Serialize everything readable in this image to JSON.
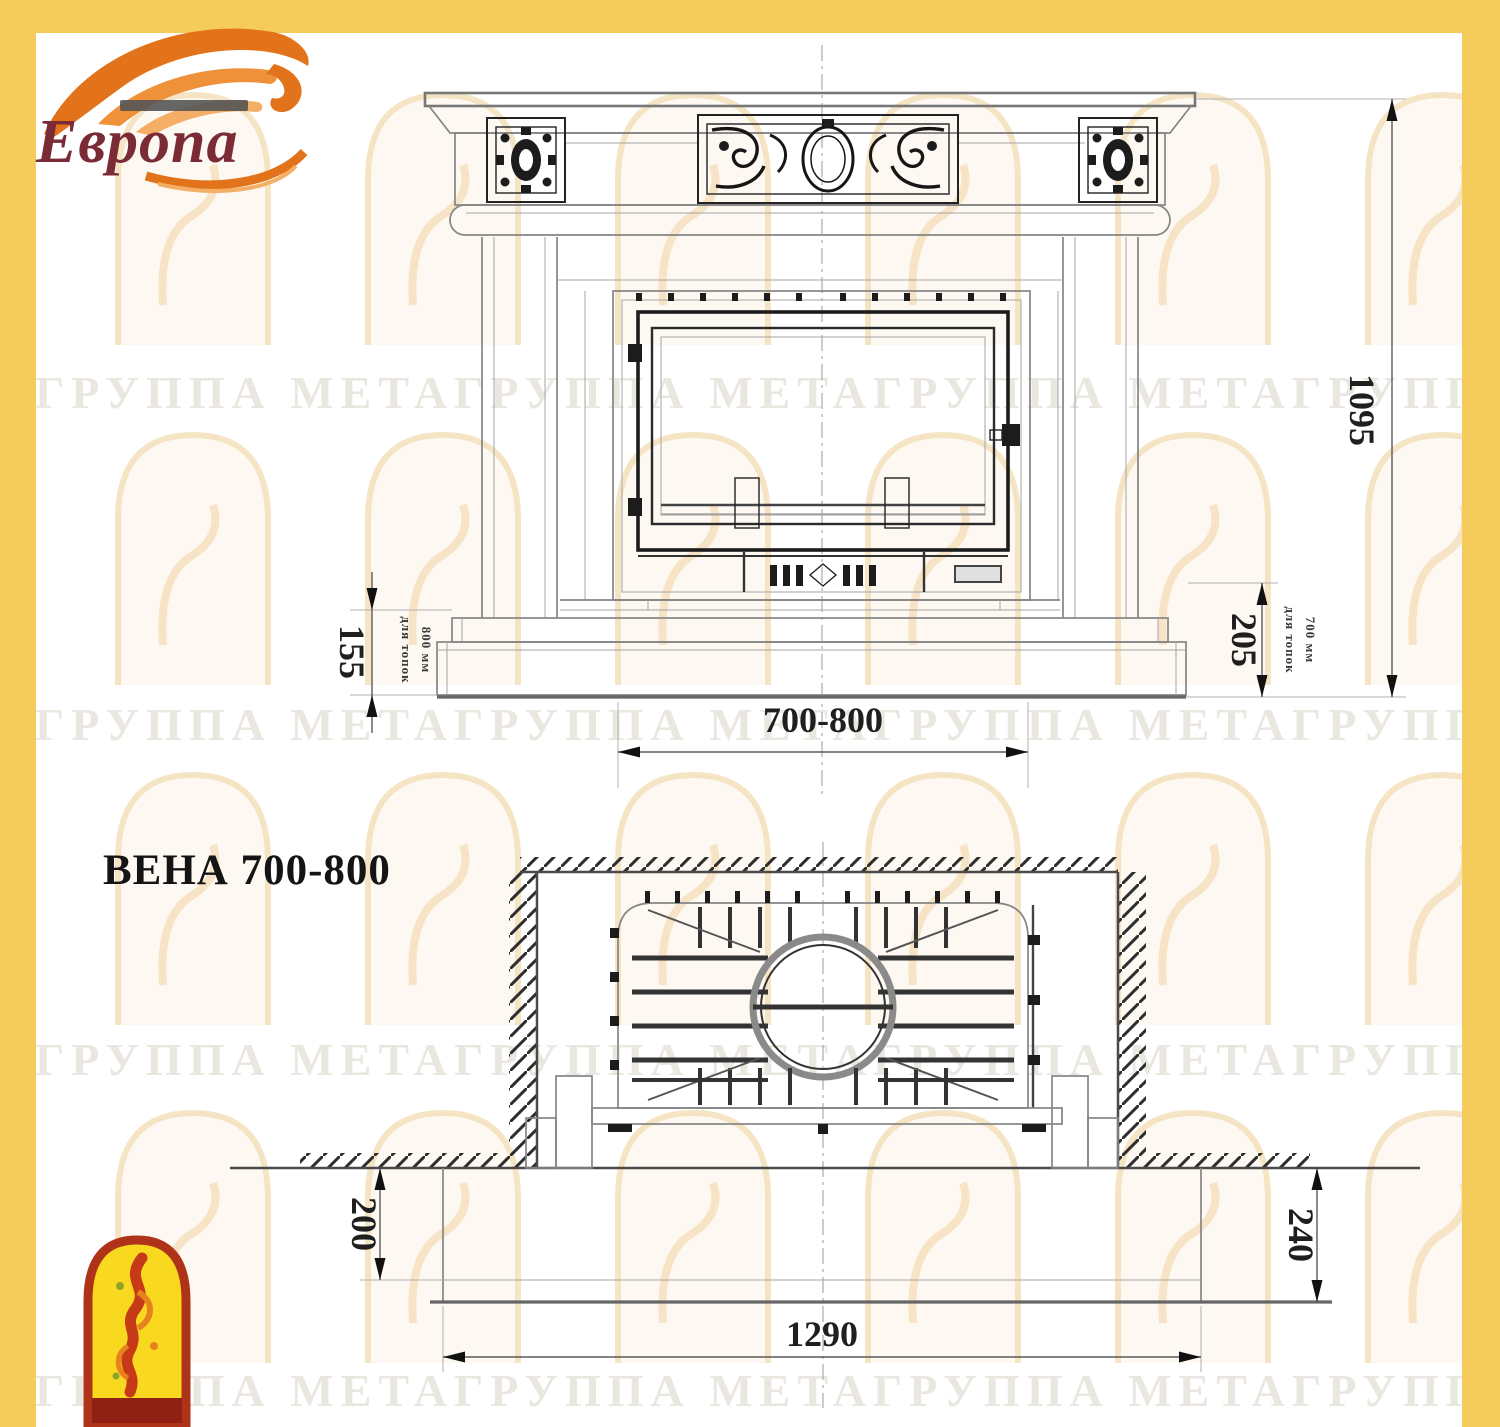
{
  "brand": {
    "logo_text": "Европа"
  },
  "front_view": {
    "height": "1095",
    "width_range": "700-800",
    "base_height_left": "155",
    "base_left_note_line1": "для топок",
    "base_left_note_line2": "800 мм",
    "base_height_right": "205",
    "base_right_note_line1": "для топок",
    "base_right_note_line2": "700 мм"
  },
  "plan_view": {
    "title": "ВЕНА 700-800",
    "hearth_depth_left": "200",
    "hearth_depth_right": "240",
    "hearth_width": "1290"
  },
  "watermark": {
    "text": "ГРУППА МЕТА",
    "row": "ГРУППА МЕТАГРУППА МЕТАГРУППА МЕТАГРУППА МЕТА"
  },
  "colors": {
    "border": "#F5CB5C",
    "logo_text": "#7A2B36",
    "flame": "#E2731A",
    "line_gray": "#858585",
    "ink": "#1f1f1f"
  }
}
